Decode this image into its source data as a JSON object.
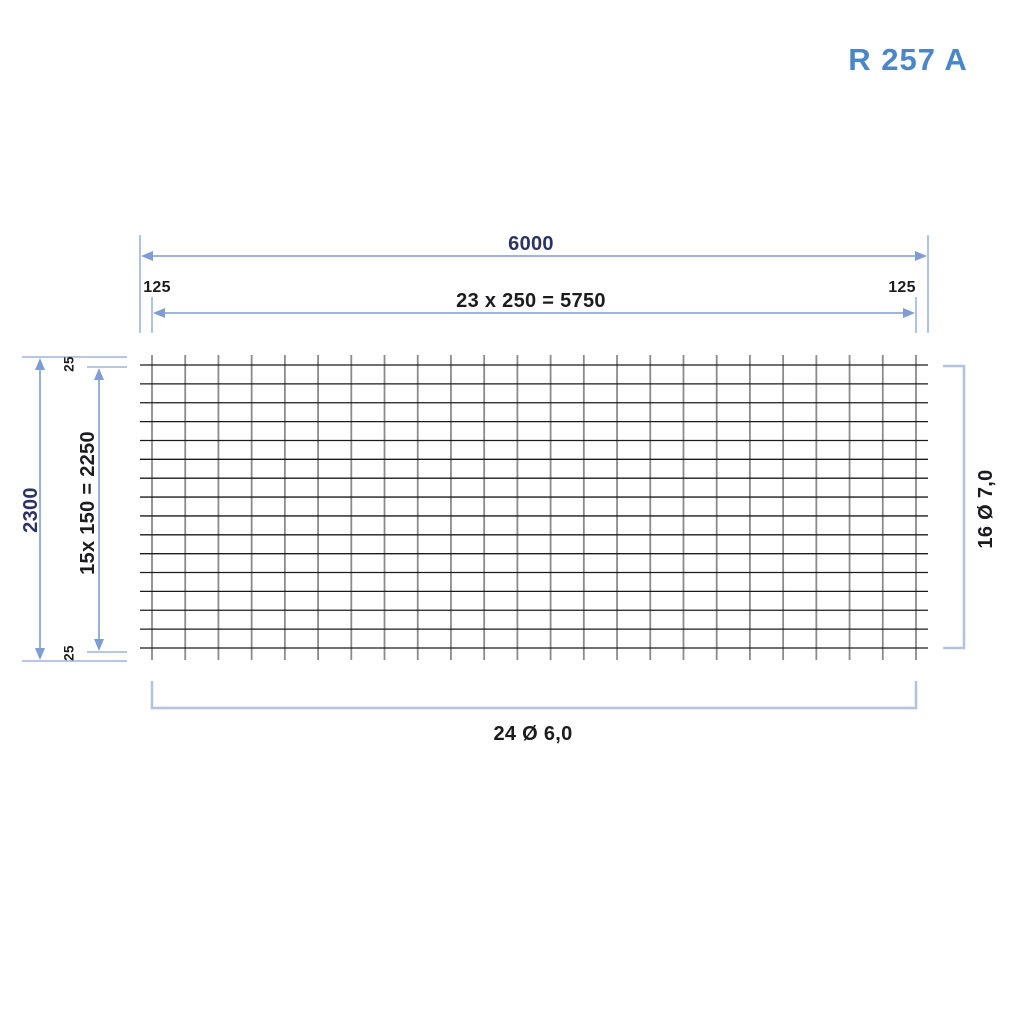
{
  "title": "R 257 A",
  "dimensions": {
    "overall_width": "6000",
    "inner_width": "23 x 250 = 5750",
    "edge_left": "125",
    "edge_right": "125",
    "overall_height": "2300",
    "inner_height": "15x 150 = 2250",
    "edge_top": "25",
    "edge_bottom": "25"
  },
  "bars": {
    "longitudinal": {
      "count": 24,
      "label": "24 Ø 6,0"
    },
    "cross": {
      "count": 16,
      "label": "16 Ø 7,0"
    }
  },
  "colors": {
    "dimension_line": "#7f9cd4",
    "extension_line": "#9db4dd",
    "bracket": "#b3c3de",
    "bar_vertical": "#8b8b8b",
    "bar_horizontal": "#1b1b1d",
    "navy_text": "#2e3263",
    "black_text": "#1c1c1e",
    "title_blue": "#4a86c8"
  }
}
